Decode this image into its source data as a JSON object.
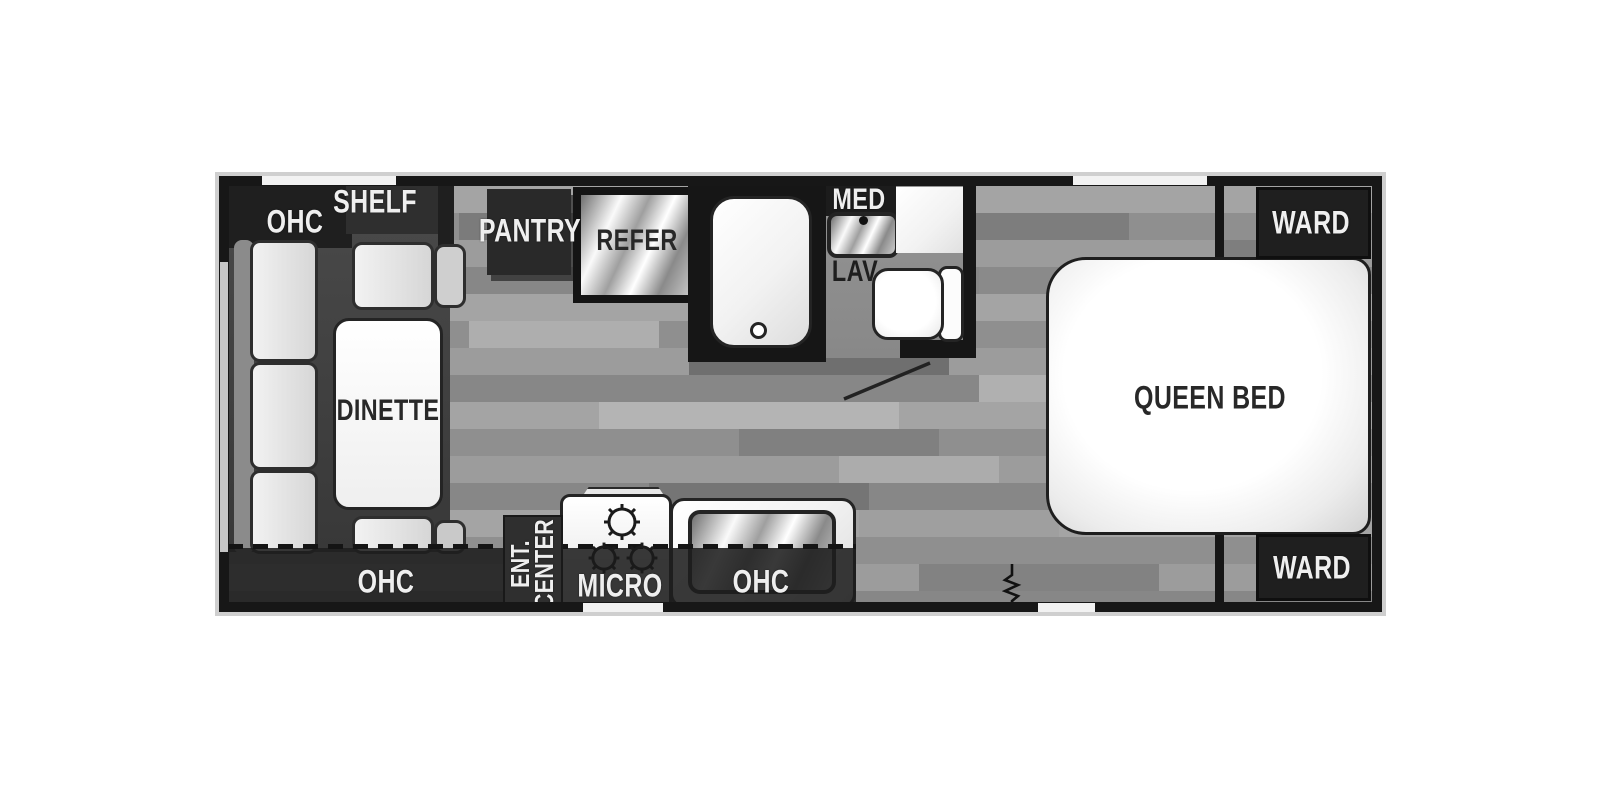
{
  "title": "Travel trailer floor plan",
  "labels": {
    "ohc_front_top": "OHC",
    "shelf": "SHELF",
    "pantry": "PANTRY",
    "refrigerator": "REFER",
    "medicine_cabinet": "MED",
    "lavatory": "LAV",
    "dinette": "DINETTE",
    "ohc_front_bottom": "OHC",
    "ent_center_line1": "ENT.",
    "ent_center_line2": "CENTER",
    "microwave": "MICRO",
    "ohc_kitchen": "OHC",
    "queen_bed": "QUEEN BED",
    "ward_front": "WARD",
    "ward_rear": "WARD"
  },
  "icons": {
    "stove_burner": "circle-with-radial-ticks",
    "tub_drain": "small-circle",
    "toilet": "rounded-bowl-with-tank",
    "bath_door_swing": "diagonal-line",
    "entry_step": "vertical-zigzag",
    "window": "white-wall-strip",
    "awning_line": "dashed-line"
  },
  "colors": {
    "wall": "#171717",
    "cabinet_dark": "#262626",
    "floor_mid": "#989898",
    "fixture_white": "#f7f7f7",
    "fixture_outline": "#242424",
    "label_light": "#efefef",
    "label_dark": "#282828",
    "outer_halo": "#cfcfcf"
  }
}
